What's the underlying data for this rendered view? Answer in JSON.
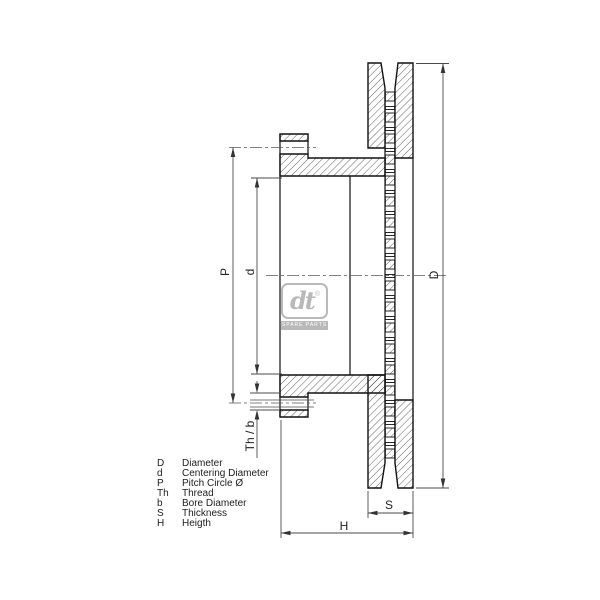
{
  "drawing": {
    "title_hint": "brake disc cross section drawing",
    "dimension_labels": {
      "pitch_circle": "P",
      "centering_diameter": "d",
      "diameter": "D",
      "thread_bore": "Th / b",
      "thickness": "S",
      "height": "H"
    },
    "legend": {
      "items": [
        {
          "symbol": "D",
          "label": "Diameter"
        },
        {
          "symbol": "d",
          "label": "Centering Diameter"
        },
        {
          "symbol": "P",
          "label": "Pitch Circle Ø"
        },
        {
          "symbol": "Th",
          "label": "Thread"
        },
        {
          "symbol": "b",
          "label": "Bore Diameter"
        },
        {
          "symbol": "S",
          "label": "Thickness"
        },
        {
          "symbol": "H",
          "label": "Heigth"
        }
      ]
    },
    "logo": {
      "brand": "dt",
      "registered": "®",
      "subtitle": "Spare Parts"
    },
    "colors": {
      "background": "#ffffff",
      "outline": "#111111",
      "hatch": "#2a2a2a",
      "dimension_line": "#4a4a4a",
      "centerline": "#5a5a5a",
      "logo_gray": "#b9b9b9"
    }
  }
}
